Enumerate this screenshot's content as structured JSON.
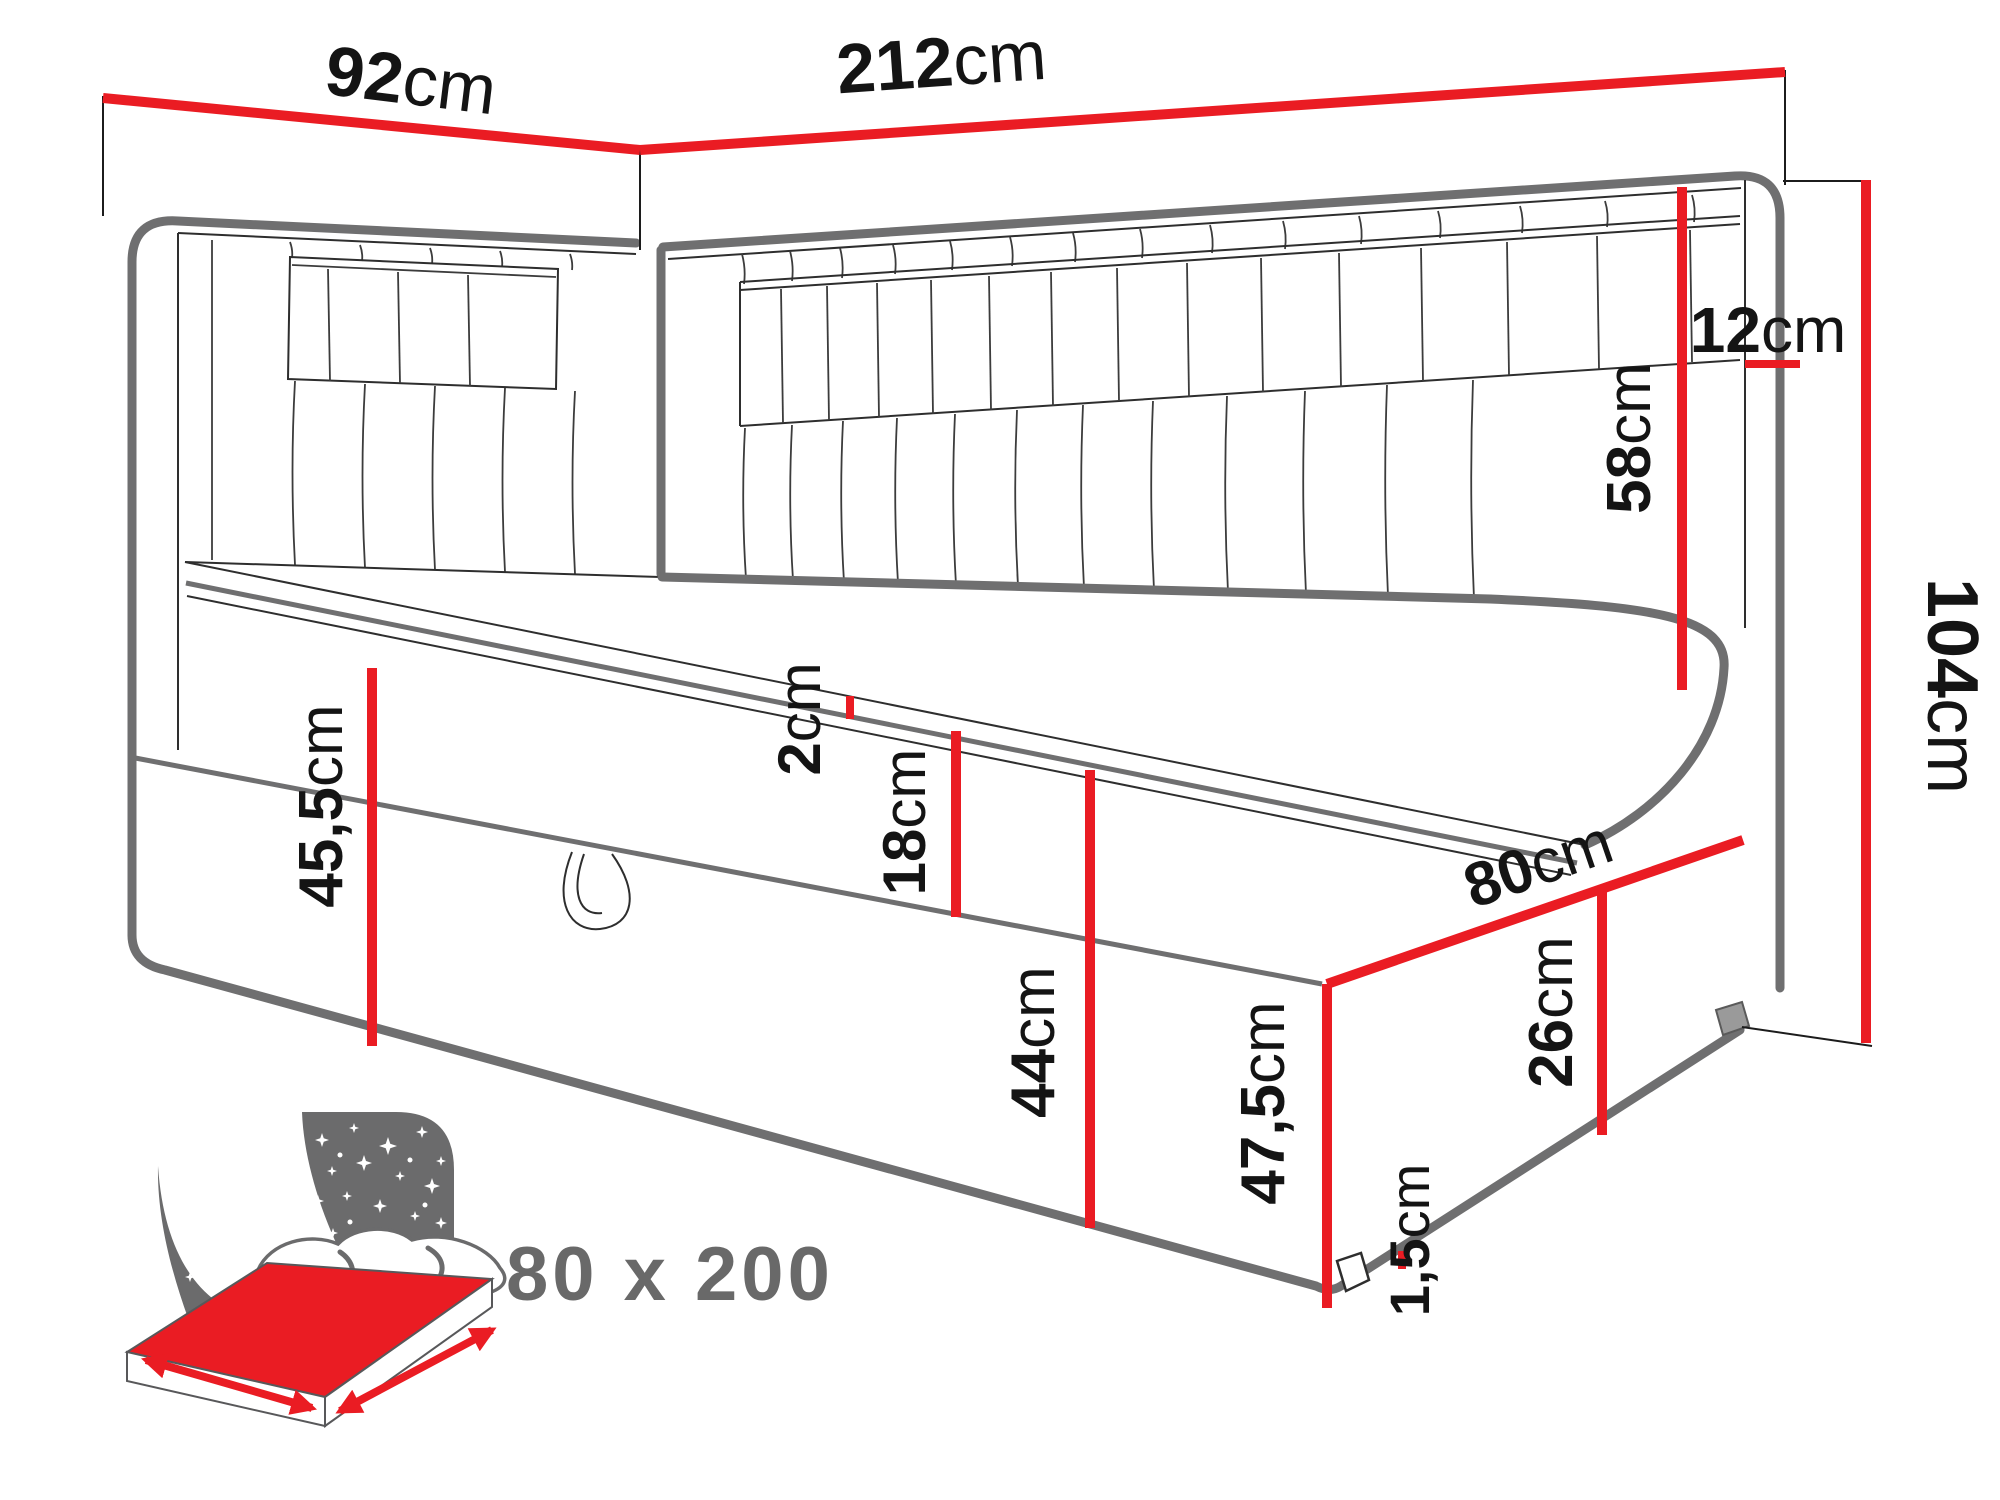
{
  "page": {
    "background": "#ffffff",
    "type": "furniture-dimension-diagram"
  },
  "colors": {
    "dimension_red": "#ea1c23",
    "outline_gray": "#6f6f70",
    "line_dark": "#2e2e2e",
    "icon_gray": "#6b6b6c",
    "text_black": "#141414",
    "size_text_gray": "#696969"
  },
  "dimensions": {
    "side_width": {
      "value": "92",
      "unit": "cm"
    },
    "total_length": {
      "value": "212",
      "unit": "cm"
    },
    "headboard_depth": {
      "value": "12",
      "unit": "cm"
    },
    "headboard_above_mattress": {
      "value": "58",
      "unit": "cm"
    },
    "total_height": {
      "value": "104",
      "unit": "cm"
    },
    "topper_thickness": {
      "value": "2",
      "unit": "cm"
    },
    "mattress_thickness": {
      "value": "18",
      "unit": "cm"
    },
    "left_base_height": {
      "value": "45,5",
      "unit": "cm"
    },
    "front_base_height": {
      "value": "44",
      "unit": "cm"
    },
    "bed_depth": {
      "value": "80",
      "unit": "cm"
    },
    "side_base_height": {
      "value": "26",
      "unit": "cm"
    },
    "right_height": {
      "value": "47,5",
      "unit": "cm"
    },
    "leg_height": {
      "value": "1,5",
      "unit": "cm"
    }
  },
  "mattress_size_label": "80 x 200"
}
